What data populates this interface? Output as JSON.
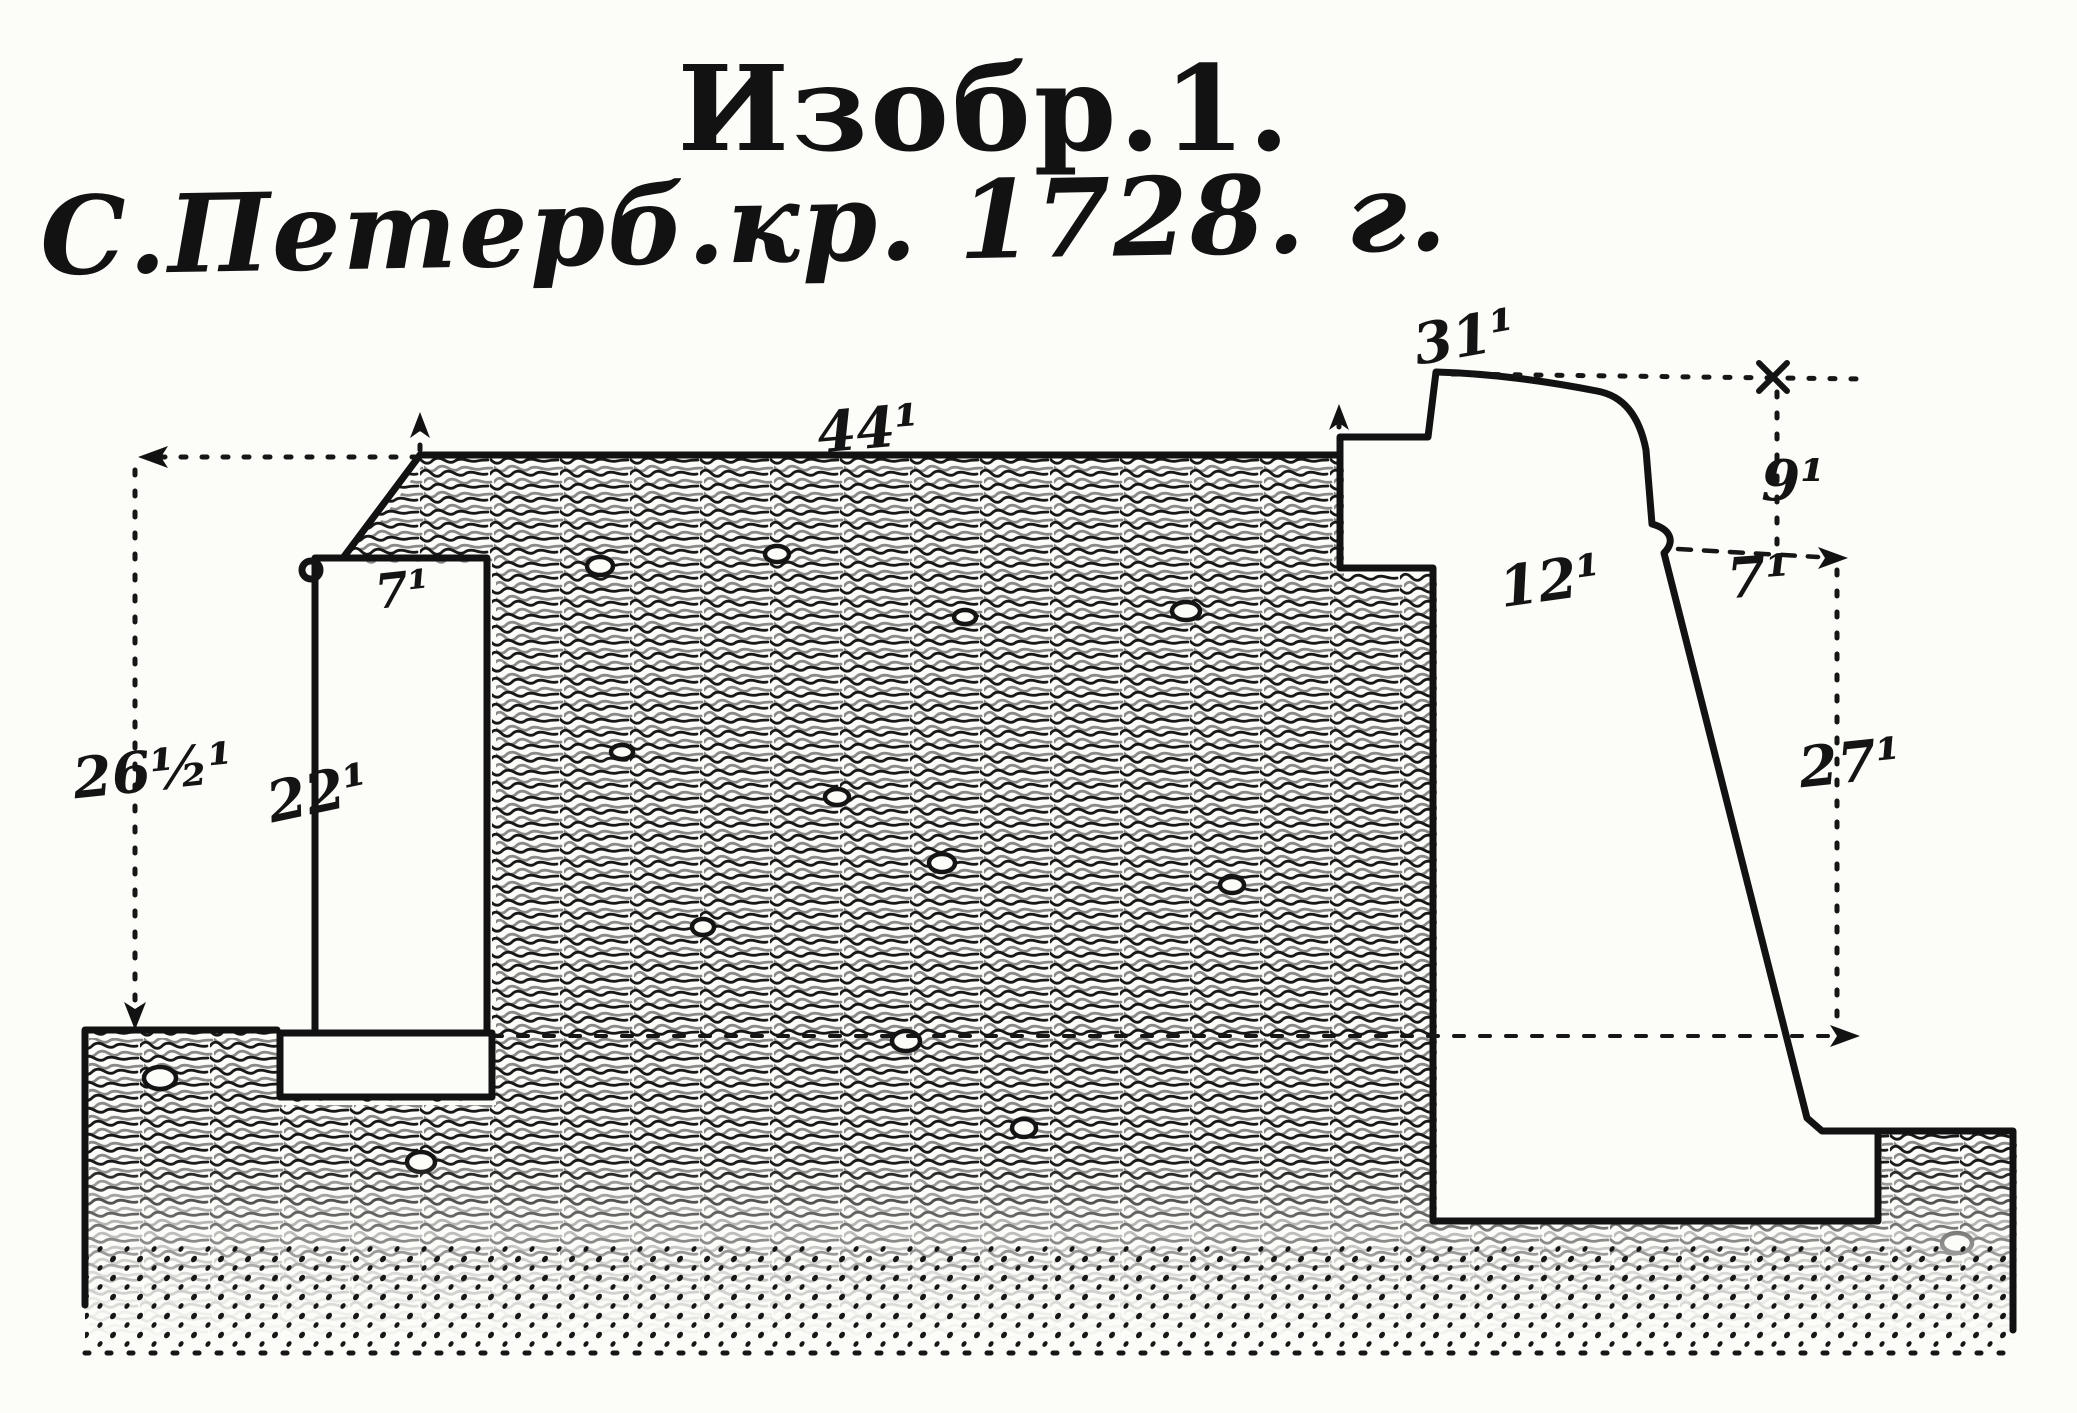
{
  "figure": {
    "title_line1": "Изобр.1.",
    "title_line2": "С.Петерб.кр. 1728. г."
  },
  "labels": {
    "rampart_top_width": "44¹",
    "crest_height": "31¹",
    "parapet_drop": "9¹",
    "cordon_offset": "7¹",
    "wall_thickness": "12¹",
    "escarp_height": "27¹",
    "ditch_depth": "26½¹",
    "counterscarp_height": "22¹",
    "counterscarp_top_width": "7¹"
  },
  "colors": {
    "ink": "#141414",
    "paper": "#fcfcf9"
  }
}
